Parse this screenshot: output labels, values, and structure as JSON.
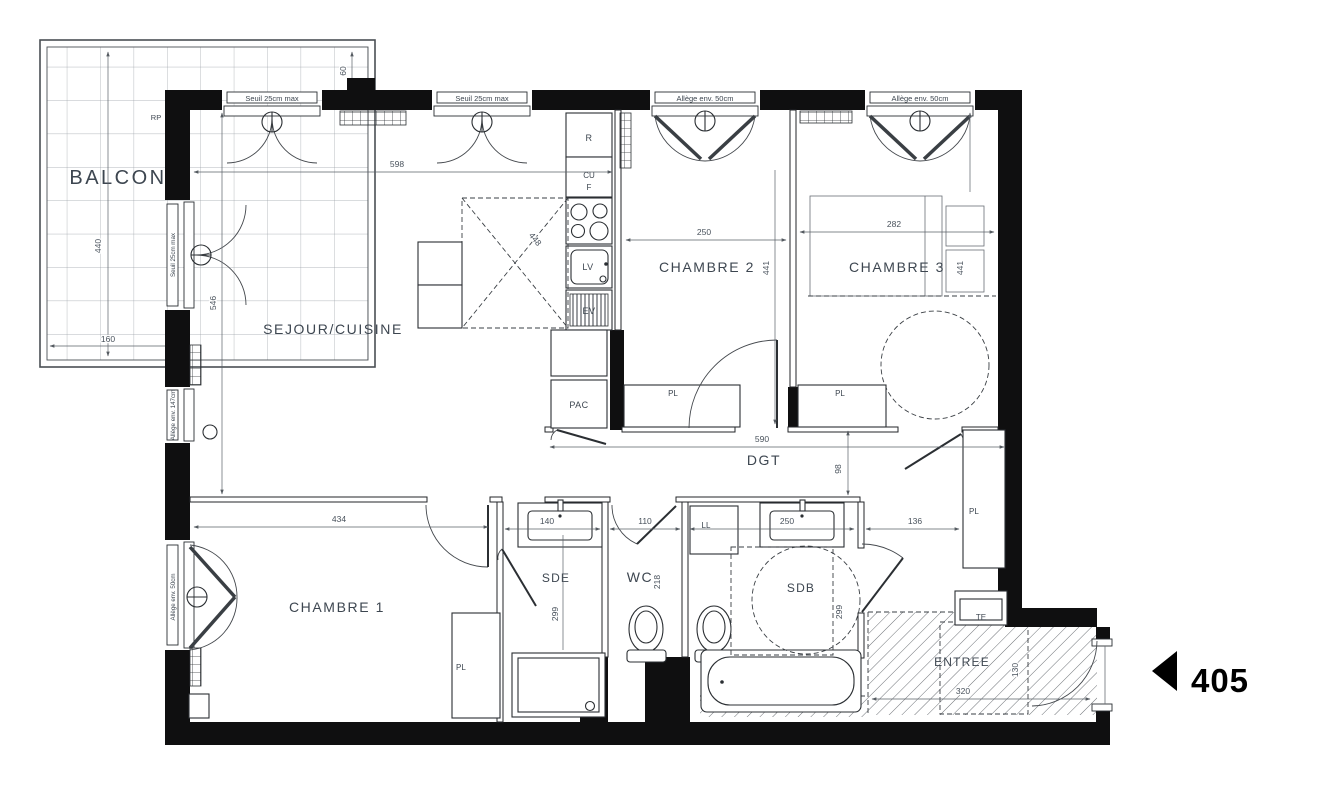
{
  "unit": {
    "number": "405"
  },
  "rooms": {
    "balcon": "BALCON",
    "sejour": "SEJOUR/CUISINE",
    "chambre1": "CHAMBRE 1",
    "chambre2": "CHAMBRE 2",
    "chambre3": "CHAMBRE 3",
    "sde": "SDE",
    "wc": "WC",
    "sdb": "SDB",
    "entree": "ENTREE",
    "dgt": "DGT"
  },
  "equipment": {
    "pac": "PAC",
    "pl": "PL",
    "ll": "LL",
    "lv": "LV",
    "ev": "EV",
    "fridge": "R",
    "cu": "CU",
    "four": "F",
    "te": "TE",
    "rp": "RP"
  },
  "notes": {
    "seuil25": "Seuil 25cm max",
    "allege50": "Allège env. 50cm",
    "allege147": "Allège env. 147cm"
  },
  "dims": {
    "balcony_depth": "440",
    "balcony_width": "160",
    "balcony_edge": "60",
    "sejour_w": "598",
    "sejour_h": "546",
    "island": "448",
    "ch2_w": "250",
    "ch2_h": "441",
    "ch3_w": "282",
    "ch3_h": "441",
    "dgt_l": "590",
    "dgt_w": "98",
    "ch1_w": "434",
    "sde_w": "140",
    "sde_h": "299",
    "wc_w": "110",
    "wc_h": "218",
    "sdb_w": "250",
    "sdb_h": "299",
    "hall_w": "136",
    "entree_w": "320",
    "entree_h": "130"
  }
}
